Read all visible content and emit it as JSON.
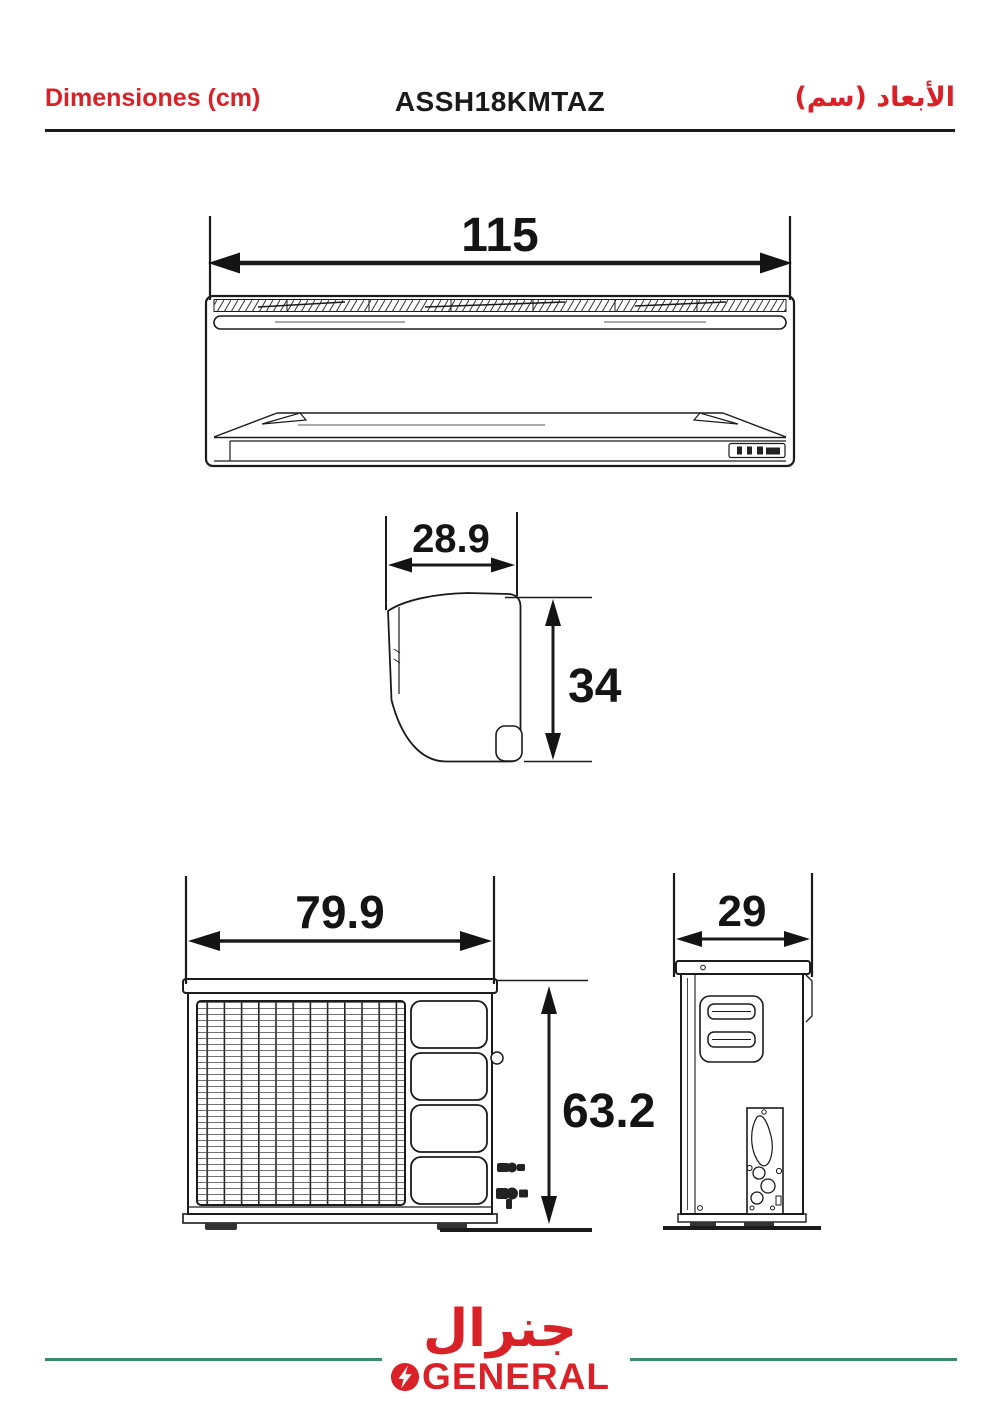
{
  "header": {
    "left_label": "Dimensiones (cm)",
    "model": "ASSH18KMTAZ",
    "right_label": "الأبعاد (سم)"
  },
  "dimensions": {
    "indoor_front_width": "115",
    "indoor_side_depth": "28.9",
    "indoor_side_height": "34",
    "outdoor_front_width": "79.9",
    "outdoor_front_height": "63.2",
    "outdoor_side_depth": "29"
  },
  "footer": {
    "brand_arabic": "جنرال",
    "brand_name": "GENERAL"
  },
  "colors": {
    "accent_red": "#d92128",
    "line_dark": "#1b1b1b",
    "footer_green": "#3d8a6b"
  }
}
